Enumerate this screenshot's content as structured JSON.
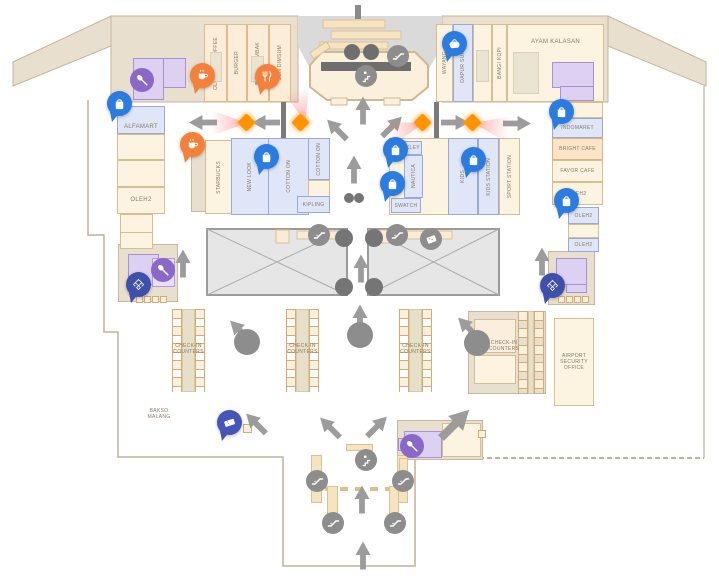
{
  "map": {
    "shops": {
      "alfamart": "ALFAMART",
      "oleh2": "OLEH2",
      "old_town_coffee": "OLD TOWN COFFEE",
      "burger": "BURGER",
      "bakso_tembak": "BAKSO TEMBAK",
      "sun_dimsum": "SUN DIMSUM",
      "wayang": "WAYANG",
      "dapur_sunda": "DAPUR SUNDA",
      "bangi_kopi": "BANGI KOPI",
      "ayam_kalasan": "AYAM KALASAN",
      "indomaret": "INDOMARET",
      "bright_cafe": "BRIGHT CAFE",
      "favor_cafe": "FAVOR CAFE",
      "starbucks": "STARBUCKS",
      "new_look": "NEW LOOK",
      "cotton_on": "COTTON ON",
      "kipling": "KIPLING",
      "oakley": "OAKLEY",
      "nautica": "NAUTICA",
      "swatch": "SWATCH",
      "kids": "KIDS",
      "kids_station": "KIDS STATION",
      "sport_station": "SPORT STATION",
      "bakso_malang": "BAKSO\nMALANG"
    },
    "areas": {
      "checkin": "CHECK-IN\nCOUNTERS",
      "security_office": "AIRPORT\nSECURITY\nOFFICE"
    },
    "icons": {
      "retail_pin": "shopping-bag-icon",
      "food_pin_coffee": "coffee-cup-icon",
      "food_pin_cutlery": "cutlery-icon",
      "drink_pin": "teapot-icon",
      "ticket_pin": "ticket-icon",
      "prayer_pin": "prayer-room-icon",
      "facility_circle": "baby-care-icon",
      "escalator": "escalator-icon",
      "stairs": "stairs-icon",
      "stamp": "ticket-stamp-icon",
      "sensor": "security-camera-diamond",
      "flow": "direction-arrow"
    },
    "colors": {
      "retail_blue": "#dfe6f7",
      "food_cream": "#fdf3e1",
      "facility_purple": "#ddd1f1",
      "terminal_tan": "#e9dfcf",
      "pin_blue": "#2b7ce0",
      "pin_orange": "#f5803a",
      "pin_navy": "#3f4fae",
      "pin_indigo": "#4656b8",
      "icon_gray": "#8d8d8d",
      "sensor_orange": "#ff9300",
      "void_gray": "#e6e6e6"
    }
  }
}
